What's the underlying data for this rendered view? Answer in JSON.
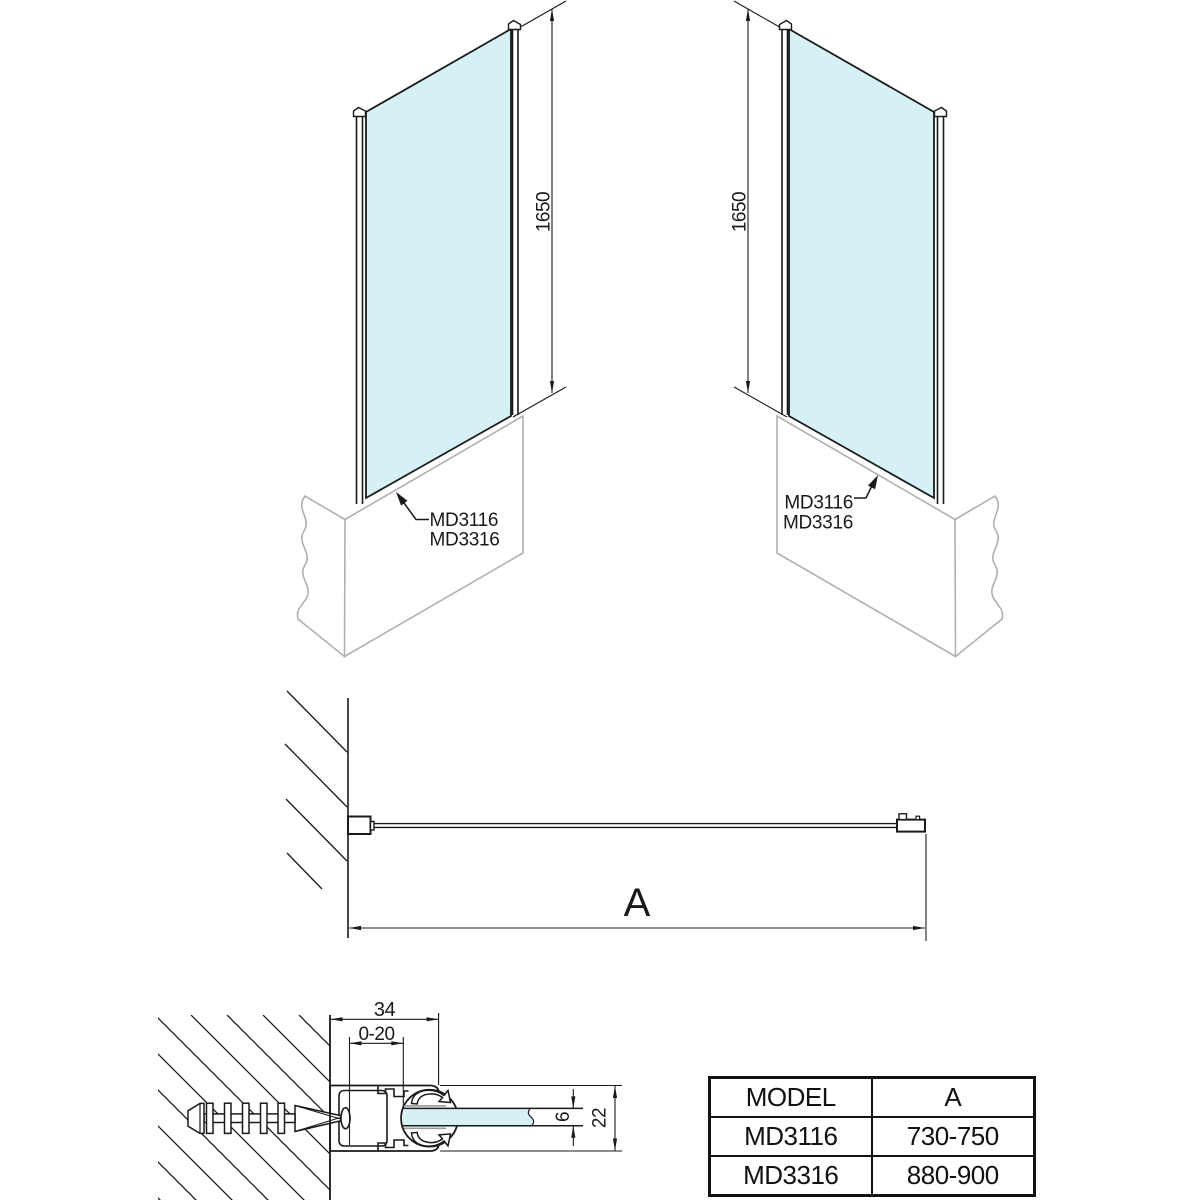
{
  "title": "Bath screen glass panel technical drawing",
  "colors": {
    "glass": "#d6f1f6",
    "line": "#1a1a1a",
    "tub": "#b0b0b0"
  },
  "views": {
    "front_left": {
      "height_dim": "1650",
      "labels": [
        "MD3116",
        "MD3316"
      ]
    },
    "front_right": {
      "height_dim": "1650",
      "labels": [
        "MD3116",
        "MD3316"
      ]
    },
    "plan": {
      "width_dim": "A"
    },
    "section": {
      "profile_width": "34",
      "adjust_range": "0-20",
      "glass_thickness": "6",
      "profile_height": "22"
    }
  },
  "table": {
    "headers": {
      "model": "MODEL",
      "a": "A"
    },
    "rows": [
      {
        "model": "MD3116",
        "a": "730-750"
      },
      {
        "model": "MD3316",
        "a": "880-900"
      }
    ]
  }
}
